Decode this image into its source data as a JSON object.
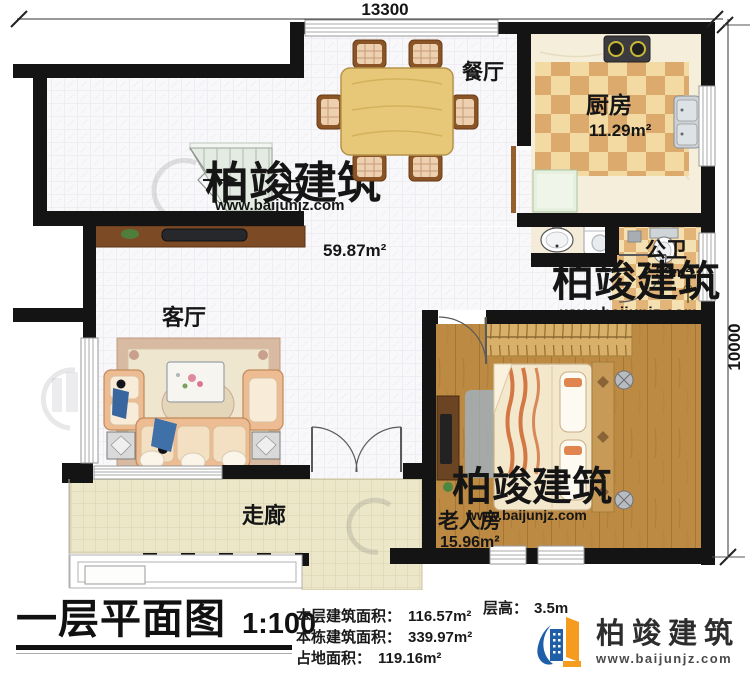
{
  "dimensions": {
    "top": "13300",
    "right": "10000"
  },
  "rooms": {
    "dining": {
      "label": "餐厅"
    },
    "kitchen": {
      "label": "厨房",
      "area": "11.29m²"
    },
    "bath": {
      "label": "公卫",
      "area": "2.59m²"
    },
    "living": {
      "label": "客厅"
    },
    "bedroom": {
      "label": "老人房",
      "area": "15.96m²"
    },
    "corridor": {
      "label": "走廊"
    },
    "stairs": {
      "label": "上"
    },
    "open_plan": {
      "area": "59.87m²"
    }
  },
  "title_block": {
    "title": "一层平面图",
    "scale": "1:100",
    "stats": [
      {
        "label": "本层建筑面积：",
        "value": "116.57m²"
      },
      {
        "label": "本栋建筑面积：",
        "value": "339.97m²"
      },
      {
        "label": "占地面积：",
        "value": "119.16m²"
      }
    ],
    "floor_height_label": "层高：",
    "floor_height_value": "3.5m"
  },
  "brand": {
    "name": "柏竣建筑",
    "website": "www.baijunjz.com"
  },
  "colors": {
    "wall": "#141414",
    "kitchen_checker_dark": "#dcaa6c",
    "kitchen_checker_light": "#f3d9a2",
    "wood_floor": "#bc8a43",
    "corridor_tile": "#ece7c9",
    "brand_blue": "#1f5fa8",
    "brand_orange": "#f59b1e"
  }
}
